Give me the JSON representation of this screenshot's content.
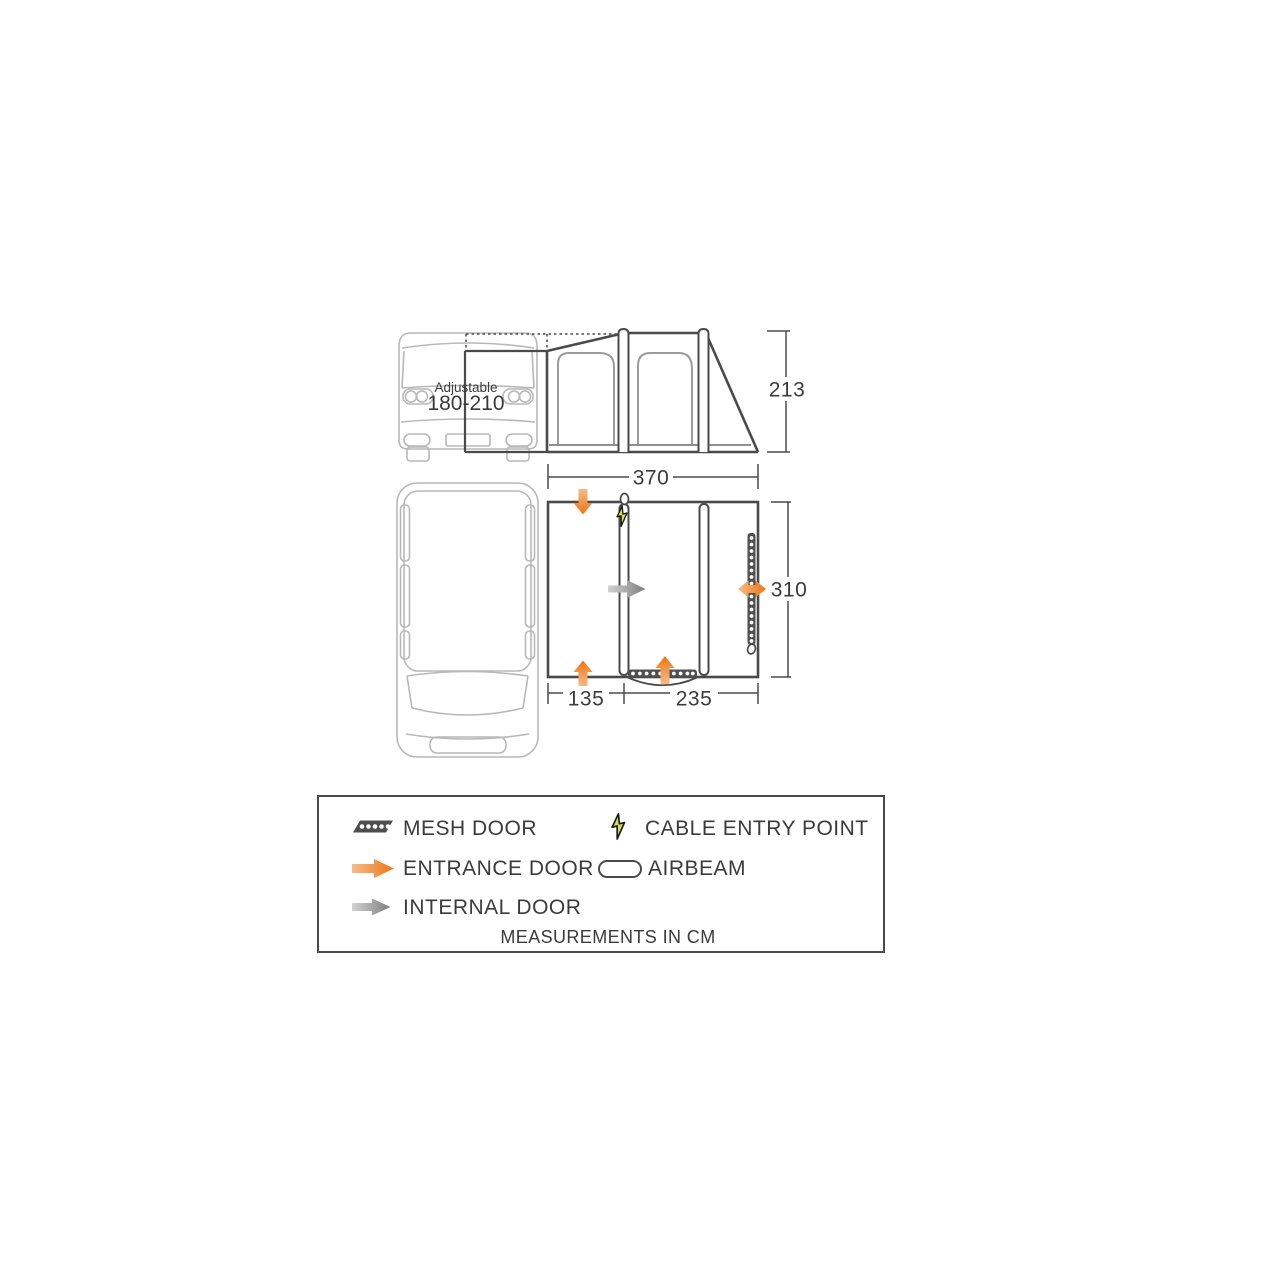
{
  "diagram": {
    "title_hidden": "",
    "van_overlay": {
      "line1": "Adjustable",
      "line2": "180-210"
    },
    "dimensions": {
      "height": "213",
      "width": "370",
      "depth": "310",
      "section_left": "135",
      "section_right": "235"
    },
    "legend": {
      "items": [
        {
          "icon": "mesh-door-icon",
          "label": "MESH DOOR"
        },
        {
          "icon": "cable-entry-icon",
          "label": "CABLE ENTRY POINT"
        },
        {
          "icon": "entrance-door-icon",
          "label": "ENTRANCE DOOR"
        },
        {
          "icon": "airbeam-icon",
          "label": "AIRBEAM"
        },
        {
          "icon": "internal-door-icon",
          "label": "INTERNAL DOOR"
        }
      ],
      "footer": "MEASUREMENTS IN CM"
    },
    "colors": {
      "accent_orange": "#ee7d23",
      "internal_gray": "#8d8d8d",
      "cable_yellow": "#d9e04f",
      "line_dark": "#4a4a4a",
      "van_gray": "#b8b8b8"
    }
  }
}
